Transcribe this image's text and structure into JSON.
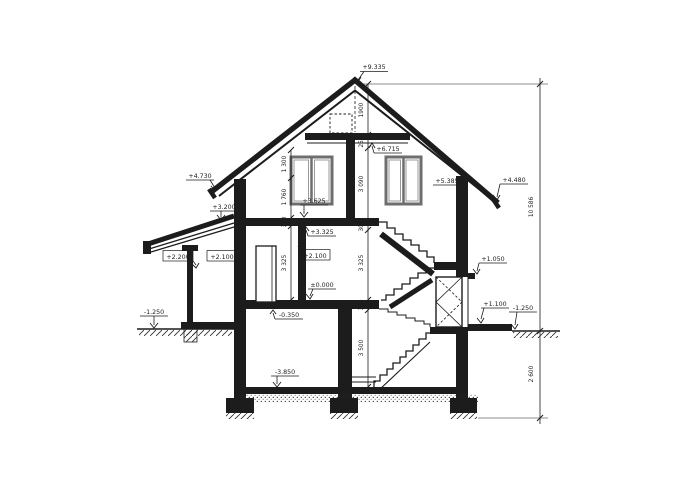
{
  "drawing": {
    "kind": "house cross-section",
    "levels": {
      "ridge": "+9.335",
      "attic_ceiling": "+6.715",
      "knee_wall_top": "+5.385",
      "eaves_left": "+4.730",
      "eaves_right": "+4.480",
      "floor2": "+3.625",
      "floor2_slab_bottom": "+3.325",
      "porch_roof": "+3.200",
      "porch_beam": "+2.200",
      "porch_ceiling": "+2.100",
      "door_head": "+2.100",
      "stair_landing": "+1.050",
      "ground_floor": "±0.000",
      "basement_ceiling": "-0.350",
      "right_pad": "+1.100",
      "terrain_left": "-1.250",
      "terrain_right": "-1.250",
      "basement_floor": "-3.850"
    },
    "dimensions": {
      "overall_height": "10 586",
      "below_grade": "2 600",
      "center_chain": [
        "1900",
        "250",
        "3 090",
        "300",
        "3 325",
        "350",
        "3 500"
      ],
      "left_chain": [
        "1 300",
        "1 760",
        "300",
        "3 325"
      ]
    },
    "colors": {
      "ink": "#1c1c1c",
      "background": "#ffffff",
      "window_frame": "#6e6e6e"
    }
  }
}
